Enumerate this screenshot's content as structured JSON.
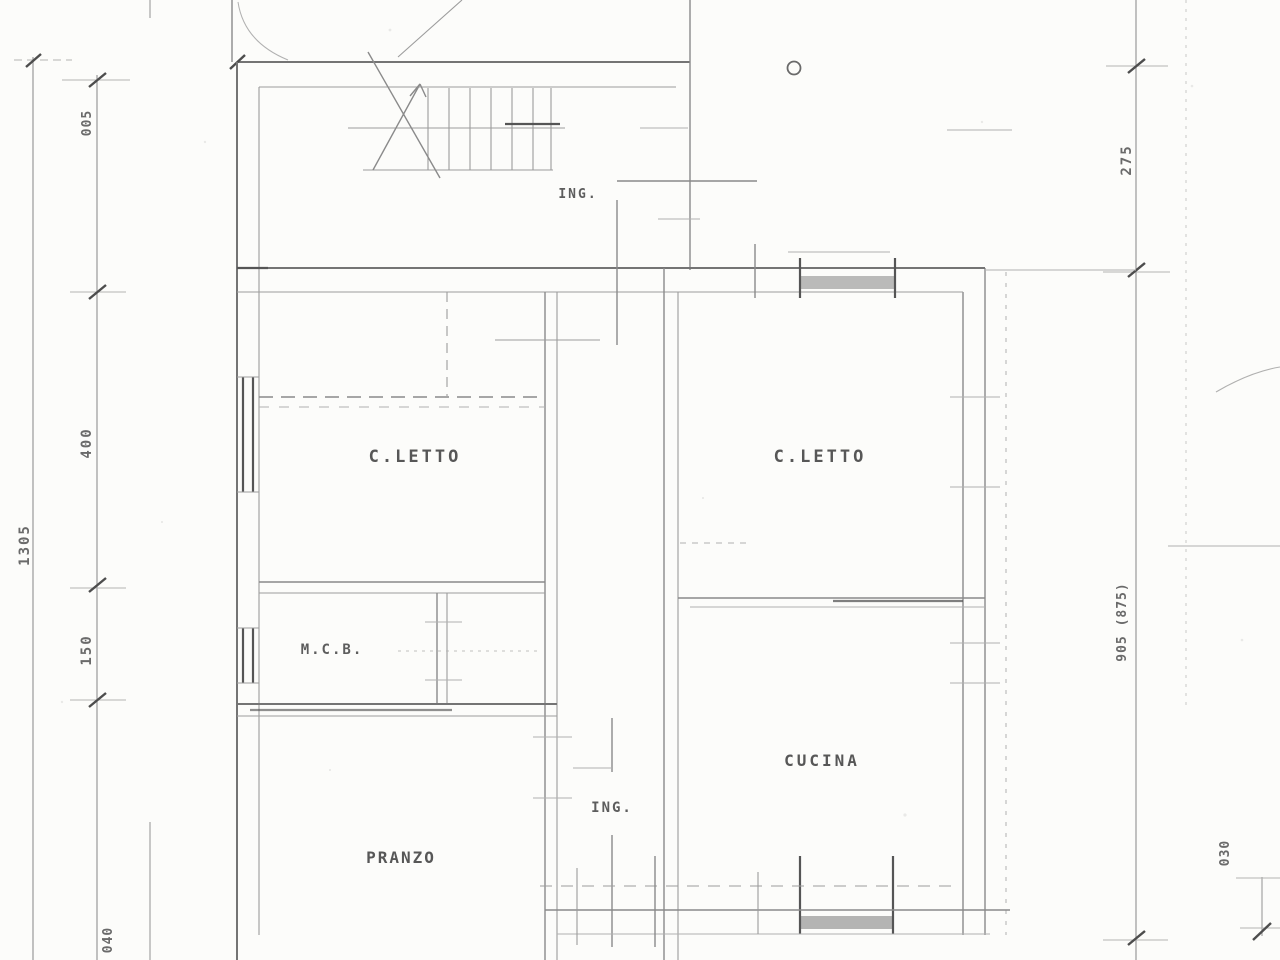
{
  "drawing": {
    "kind": "scanned floor plan",
    "rooms": {
      "ing_top": "ING.",
      "cletto_left": "C.LETTO",
      "cletto_right": "C.LETTO",
      "mcb": "M.C.B.",
      "cucina": "CUCINA",
      "ing_bottom": "ING.",
      "pranzo": "PRANZO"
    },
    "dimensions": {
      "left_small_top": "005",
      "left_upper": "400",
      "left_lower": "150",
      "left_total": "1305",
      "left_bottom": "040",
      "right_top": "275",
      "right_main": "905 (875)",
      "right_bottom": "030"
    },
    "markers": {
      "circle_marker": "O"
    },
    "colors": {
      "paper": "#fcfcfa",
      "ink": "#5c5c5c",
      "ink_dark": "#4d4d4d",
      "ink_light": "#b0b0b0"
    }
  }
}
